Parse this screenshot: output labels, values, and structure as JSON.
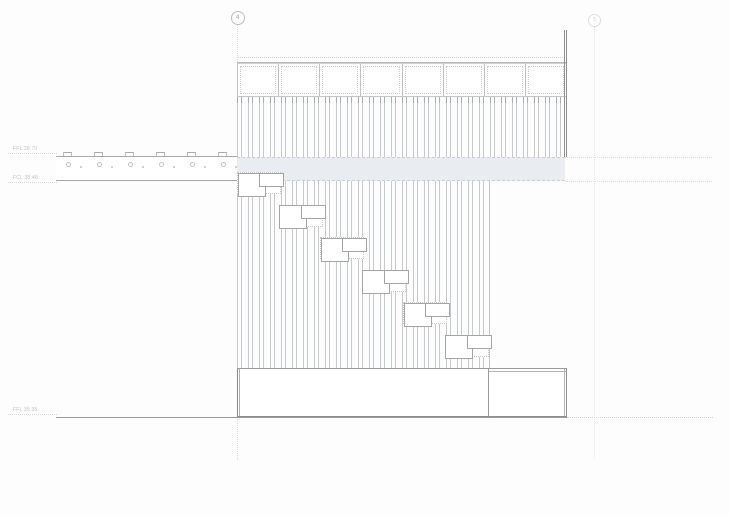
{
  "drawing_title": "Building section with stepped stair and canopy",
  "grid": {
    "markers": [
      {
        "label": "4"
      },
      {
        "label": "5"
      }
    ]
  },
  "levels": [
    {
      "label": "FFL 38.70"
    },
    {
      "label": "FCL 38.46"
    },
    {
      "label": "FFL 35.35"
    }
  ],
  "building": {
    "clerestory_panels": {
      "count": 8
    },
    "stair_steps": {
      "count": 6,
      "dx": 41.5,
      "dy": 32.5
    },
    "canopy": {
      "clip_count": 6,
      "fixing_circle_count": 6,
      "fixing_dot_count": 6
    }
  },
  "colors": {
    "slab_band_fill": "#e9edf2",
    "hatch_line": "#c7cacd",
    "outline_dark": "#8f8f8f",
    "dashed_grid": "#d9d9d9",
    "label_text": "#bfbfbf"
  }
}
